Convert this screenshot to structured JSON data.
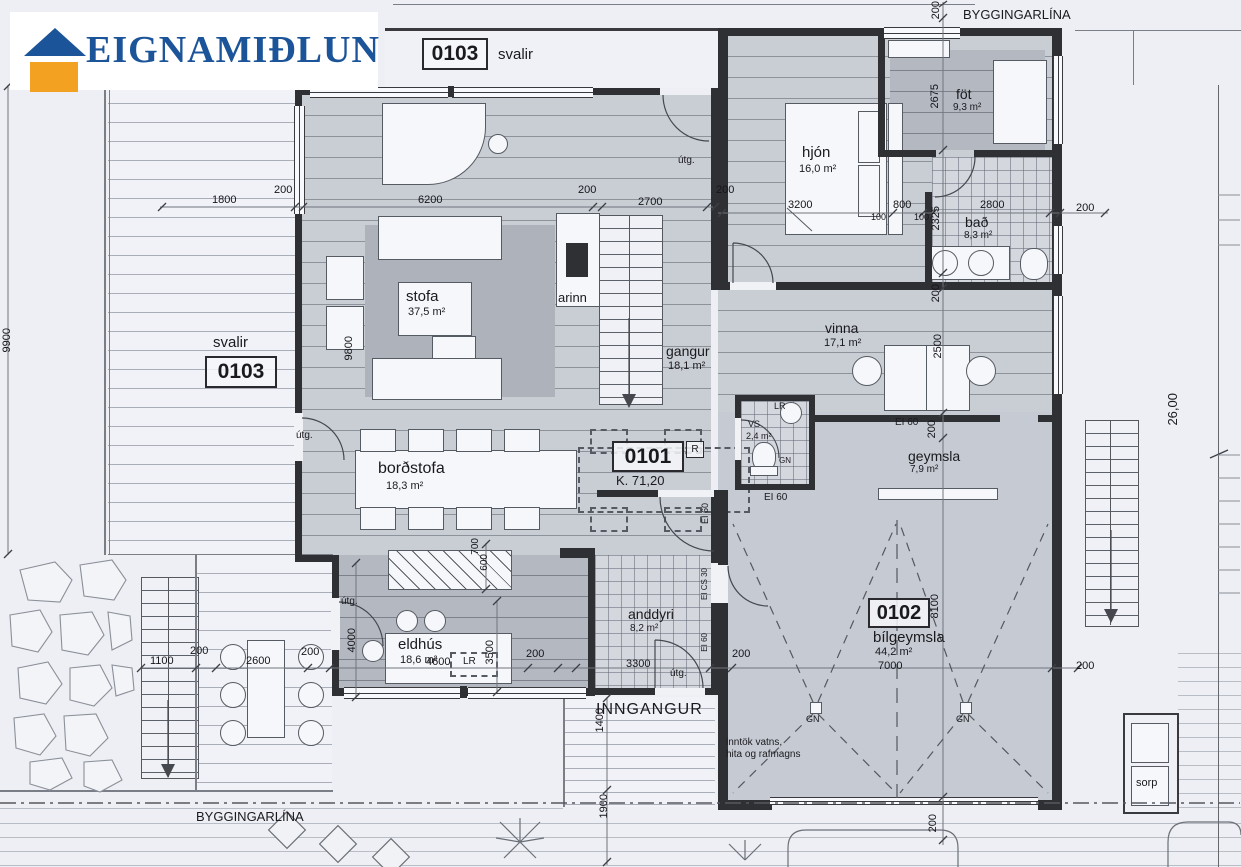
{
  "brand": {
    "name": "EIGNAMIÐLUN"
  },
  "units": {
    "u0101": "0101",
    "u0102": "0102",
    "u0103": "0103",
    "r_mark": "R",
    "level": "K. 71,20"
  },
  "rooms": {
    "stofa": {
      "name": "stofa",
      "area": "37,5 m²"
    },
    "arinn": {
      "name": "arinn"
    },
    "hjon": {
      "name": "hjón",
      "area": "16,0 m²"
    },
    "fot": {
      "name": "föt",
      "area": "9,3 m²"
    },
    "bad": {
      "name": "bað",
      "area": "8,3 m²"
    },
    "vinna": {
      "name": "vinna",
      "area": "17,1 m²"
    },
    "gangur": {
      "name": "gangur",
      "area": "18,1 m²"
    },
    "bordstofa": {
      "name": "borðstofa",
      "area": "18,3 m²"
    },
    "eldhus": {
      "name": "eldhús",
      "area": "18,6 m²"
    },
    "anddyri": {
      "name": "anddyri",
      "area": "8,2 m²"
    },
    "vs": {
      "name": "VS",
      "area": "2,4 m²"
    },
    "geymsla": {
      "name": "geymsla",
      "area": "7,9 m²"
    },
    "bilgeymsla": {
      "name": "bílgeymsla",
      "area": "44,2 m²"
    },
    "svalir": {
      "name": "svalir"
    }
  },
  "annotations": {
    "byggingarlina": "BYGGINGARLÍNA",
    "inngangur": "INNGANGUR",
    "inntok_line1": "inntök vatns,",
    "inntok_line2": "hita og rafmagns",
    "sorp": "sorp",
    "utg": "útg.",
    "ei60": "EI 60",
    "ei_cs30": "EI CS 30",
    "lr": "LR",
    "gn": "GN",
    "property_length": "26,00"
  },
  "dims": {
    "d100": "100",
    "d200": "200",
    "d600": "600",
    "d700": "700",
    "d800": "800",
    "d1100": "1100",
    "d1400": "1400",
    "d1800": "1800",
    "d1900": "1900",
    "d2325": "2325",
    "d2500": "2500",
    "d2600": "2600",
    "d2675": "2675",
    "d2700": "2700",
    "d2800": "2800",
    "d3200": "3200",
    "d3300": "3300",
    "d3500": "3500",
    "d4000": "4000",
    "d4600": "4600",
    "d6200": "6200",
    "d7000": "7000",
    "d8100": "8100",
    "d9800": "9800",
    "d9900": "9900"
  },
  "colors": {
    "accent_blue": "#1b5499",
    "accent_orange": "#f2a120",
    "wall": "#2f3034",
    "floor": "#c9cdd4",
    "paper": "#edeff4"
  }
}
